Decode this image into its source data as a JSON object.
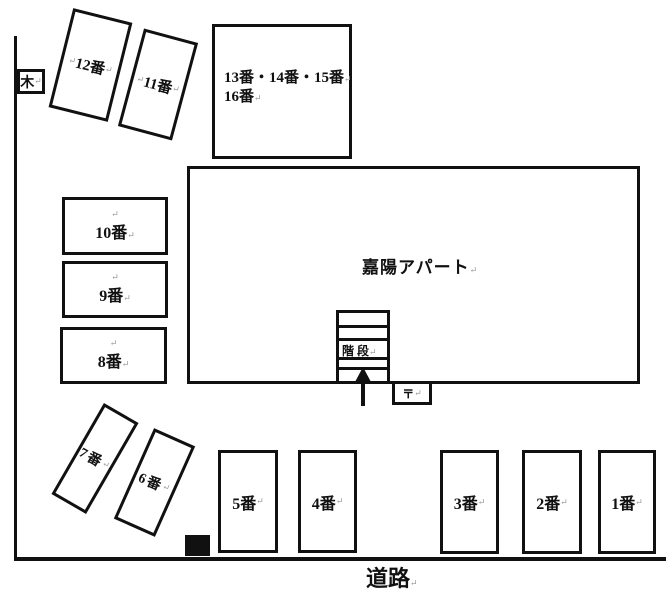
{
  "colors": {
    "ink": "#111111",
    "mark": "#999999",
    "bg": "#ffffff"
  },
  "mark": "↵",
  "tree": {
    "label": "木"
  },
  "road": {
    "label": "道路"
  },
  "building": {
    "label": "嘉陽アパート"
  },
  "stairs": {
    "label": "階 段"
  },
  "utility": {
    "label": "〒"
  },
  "group_box": {
    "line1": "13番・14番・15番",
    "line2": "16番"
  },
  "spaces": {
    "s1": "1番",
    "s2": "2番",
    "s3": "3番",
    "s4": "4番",
    "s5": "5番",
    "s6": "6番",
    "s7": "7番",
    "s8": "8番",
    "s9": "9番",
    "s10": "10番",
    "s11": "11番",
    "s12": "12番"
  }
}
